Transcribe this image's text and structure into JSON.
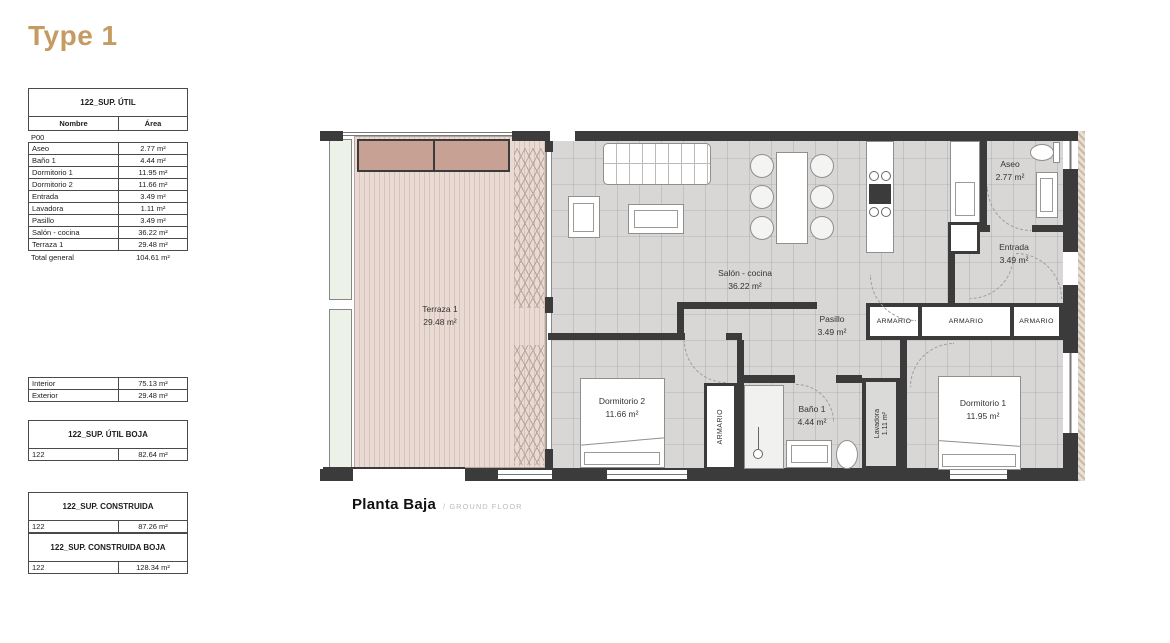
{
  "page": {
    "title": "Type 1",
    "caption": "Planta Baja",
    "caption_sub": "/ GROUND FLOOR"
  },
  "colors": {
    "accent_gold": "#C69B62",
    "wall": "#3b3b3b",
    "floor": "#d8d7d5",
    "deck": "#e2d0c8",
    "pergola": "#c7a294",
    "planter": "#edf2e9"
  },
  "tables": {
    "sup_util": {
      "title": "122_SUP. ÚTIL",
      "columns": [
        "Nombre",
        "Área"
      ],
      "group": "P00",
      "rows": [
        {
          "name": "Aseo",
          "area": "2.77 m²"
        },
        {
          "name": "Baño 1",
          "area": "4.44 m²"
        },
        {
          "name": "Dormitorio 1",
          "area": "11.95 m²"
        },
        {
          "name": "Dormitorio 2",
          "area": "11.66 m²"
        },
        {
          "name": "Entrada",
          "area": "3.49 m²"
        },
        {
          "name": "Lavadora",
          "area": "1.11 m²"
        },
        {
          "name": "Pasillo",
          "area": "3.49 m²"
        },
        {
          "name": "Salón - cocina",
          "area": "36.22 m²"
        },
        {
          "name": "Terraza 1",
          "area": "29.48 m²"
        }
      ],
      "total": {
        "name": "Total general",
        "area": "104.61 m²"
      }
    },
    "int_ext": {
      "rows": [
        {
          "name": "Interior",
          "area": "75.13 m²"
        },
        {
          "name": "Exterior",
          "area": "29.48 m²"
        }
      ]
    },
    "util_boja": {
      "title": "122_SUP. ÚTIL BOJA",
      "row": {
        "name": "122",
        "area": "82.64 m²"
      }
    },
    "construida": {
      "title": "122_SUP. CONSTRUIDA",
      "row": {
        "name": "122",
        "area": "87.26 m²"
      }
    },
    "construida_boja": {
      "title": "122_SUP. CONSTRUIDA BOJA",
      "row": {
        "name": "122",
        "area": "128.34 m²"
      }
    }
  },
  "plan": {
    "closet_label": "ARMARIO",
    "rooms": {
      "terraza": {
        "name": "Terraza 1",
        "area": "29.48 m²"
      },
      "salon": {
        "name": "Salón - cocina",
        "area": "36.22 m²"
      },
      "pasillo": {
        "name": "Pasillo",
        "area": "3.49 m²"
      },
      "aseo": {
        "name": "Aseo",
        "area": "2.77 m²"
      },
      "entrada": {
        "name": "Entrada",
        "area": "3.49 m²"
      },
      "dormitorio2": {
        "name": "Dormitorio 2",
        "area": "11.66 m²"
      },
      "bano": {
        "name": "Baño 1",
        "area": "4.44 m²"
      },
      "lavadora": {
        "name": "Lavadora",
        "area": "1.11 m²"
      },
      "dormitorio1": {
        "name": "Dormitorio 1",
        "area": "11.95 m²"
      }
    }
  }
}
